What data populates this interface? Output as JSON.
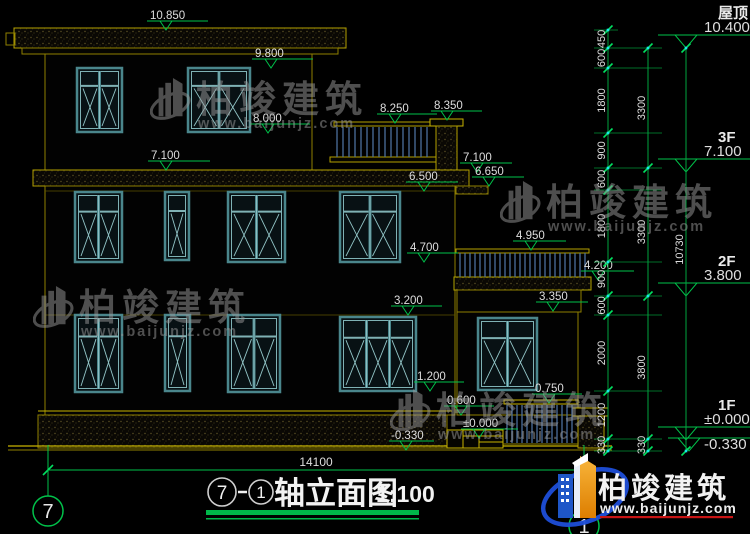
{
  "drawing": {
    "title": {
      "axis_start": "7",
      "dash": "-",
      "axis_end": "1",
      "name": "轴立面图",
      "scale": "1:100"
    },
    "bottom_dim": "14100",
    "axis_bubbles": {
      "left": "7",
      "right": "1"
    },
    "floor_levels": [
      {
        "name": "屋顶",
        "value": "10.400",
        "y": 48
      },
      {
        "name": "3F",
        "value": "7.100",
        "y": 172
      },
      {
        "name": "2F",
        "value": "3.800",
        "y": 296
      },
      {
        "name": "1F",
        "value": "±0.000",
        "value2": "-0.330",
        "y": 440,
        "y2": 451
      }
    ],
    "elevation_markers": [
      {
        "label": "10.850",
        "tx": 166,
        "ty": 30,
        "x1": 147,
        "x2": 208,
        "tax": 150
      },
      {
        "label": "9.800",
        "tx": 271,
        "ty": 68,
        "x1": 252,
        "x2": 313,
        "tax": 255
      },
      {
        "label": "8.000",
        "tx": 268,
        "ty": 133,
        "x1": 250,
        "x2": 310,
        "tax": 253
      },
      {
        "label": "8.250",
        "tx": 395,
        "ty": 123,
        "x1": 377,
        "x2": 437,
        "tax": 380
      },
      {
        "label": "8.350",
        "tx": 447,
        "ty": 120,
        "x1": 431,
        "x2": 482,
        "tax": 434
      },
      {
        "label": "7.100",
        "tx": 166,
        "ty": 170,
        "x1": 148,
        "x2": 210,
        "tax": 151
      },
      {
        "label": "7.100",
        "tx": 477,
        "ty": 172,
        "x1": 460,
        "x2": 512,
        "tax": 463
      },
      {
        "label": "6.650",
        "tx": 489,
        "ty": 186,
        "x1": 472,
        "x2": 524,
        "tax": 475
      },
      {
        "label": "6.500",
        "tx": 424,
        "ty": 191,
        "x1": 406,
        "x2": 458,
        "tax": 409
      },
      {
        "label": "4.950",
        "tx": 531,
        "ty": 250,
        "x1": 513,
        "x2": 566,
        "tax": 516
      },
      {
        "label": "4.700",
        "tx": 424,
        "ty": 262,
        "x1": 407,
        "x2": 458,
        "tax": 410
      },
      {
        "label": "4.200",
        "tx": 598,
        "ty": 280,
        "x1": 581,
        "x2": 634,
        "tax": 584
      },
      {
        "label": "3.350",
        "tx": 553,
        "ty": 311,
        "x1": 536,
        "x2": 588,
        "tax": 539
      },
      {
        "label": "3.200",
        "tx": 408,
        "ty": 315,
        "x1": 391,
        "x2": 442,
        "tax": 394
      },
      {
        "label": "1.200",
        "tx": 430,
        "ty": 391,
        "x1": 414,
        "x2": 464,
        "tax": 417
      },
      {
        "label": "0.750",
        "tx": 549,
        "ty": 403,
        "x1": 532,
        "x2": 582,
        "tax": 535
      },
      {
        "label": "0.600",
        "tx": 461,
        "ty": 415,
        "x1": 444,
        "x2": 494,
        "tax": 447
      },
      {
        "label": "±0.000",
        "tx": 479,
        "ty": 438,
        "x1": 461,
        "x2": 518,
        "tax": 463
      },
      {
        "label": "-0.330",
        "tx": 406,
        "ty": 450,
        "x1": 389,
        "x2": 434,
        "tax": 391
      }
    ],
    "dim_chains": {
      "chain1": [
        "450",
        "600",
        "1800",
        "900",
        "600",
        "1800",
        "900",
        "600",
        "2000",
        "1200",
        "330"
      ],
      "chain2": [
        "3300",
        "3300",
        "3800",
        "330"
      ],
      "chain3": [
        "10730"
      ]
    },
    "windows": {
      "floor3": [
        {
          "x": 77,
          "y": 68,
          "w": 45,
          "h": 64,
          "type": "double"
        },
        {
          "x": 188,
          "y": 68,
          "w": 62,
          "h": 64,
          "type": "double"
        }
      ],
      "floor2": [
        {
          "x": 75,
          "y": 192,
          "w": 47,
          "h": 70,
          "type": "double"
        },
        {
          "x": 165,
          "y": 192,
          "w": 24,
          "h": 68,
          "type": "single"
        },
        {
          "x": 228,
          "y": 192,
          "w": 57,
          "h": 70,
          "type": "double"
        },
        {
          "x": 340,
          "y": 192,
          "w": 60,
          "h": 70,
          "type": "double"
        }
      ],
      "floor1": [
        {
          "x": 75,
          "y": 315,
          "w": 47,
          "h": 77,
          "type": "double"
        },
        {
          "x": 165,
          "y": 315,
          "w": 25,
          "h": 76,
          "type": "single"
        },
        {
          "x": 228,
          "y": 315,
          "w": 52,
          "h": 77,
          "type": "double"
        },
        {
          "x": 340,
          "y": 317,
          "w": 76,
          "h": 74,
          "type": "triple"
        },
        {
          "x": 478,
          "y": 318,
          "w": 59,
          "h": 72,
          "type": "double"
        }
      ]
    }
  },
  "watermark": {
    "text": "柏竣建筑",
    "url": "www.baijunjz.com",
    "positions": [
      {
        "x": 150,
        "y": 75
      },
      {
        "x": 500,
        "y": 178
      },
      {
        "x": 33,
        "y": 283
      },
      {
        "x": 390,
        "y": 386
      }
    ]
  },
  "logo": {
    "text": "柏竣建筑",
    "url": "www.baijunjz.com"
  },
  "colors": {
    "line_yellow": "#ab9a00",
    "bright_yellow": "#c8b400",
    "green": "#00c24a",
    "dim_green": "#00a33e",
    "window_teal": "#4a868c",
    "bar_blue": "#4c6e9e",
    "text_white": "#dedede",
    "logo_blue": "#1d4ed8",
    "logo_orange": "#f6a623",
    "logo_red": "#c81414"
  }
}
